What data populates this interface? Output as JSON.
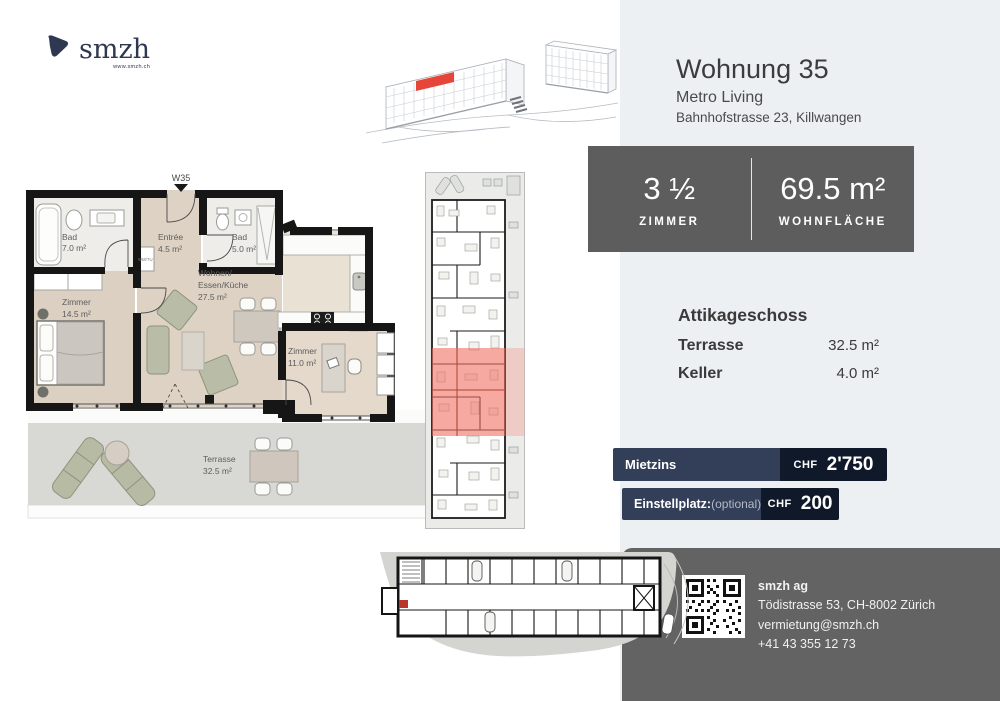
{
  "colors": {
    "navy": "#2e3850",
    "bar_left_navy": "#333f58",
    "bar_right_navy": "#10192a",
    "stats_gray": "#5d5d5d",
    "contact_gray": "#636363",
    "panel_gray": "#edf0f3",
    "highlight_red": "#e6463a",
    "plan_highlight_pink": "#ef6f63"
  },
  "logo": {
    "brand": "smzh",
    "url": "www.smzh.ch"
  },
  "header": {
    "title": "Wohnung 35",
    "project": "Metro Living",
    "address": "Bahnhofstrasse 23, Killwangen"
  },
  "stats": {
    "rooms": {
      "value": "3 ½",
      "label": "ZIMMER"
    },
    "area": {
      "value": "69.5 m²",
      "label": "WOHNFLÄCHE"
    }
  },
  "details": {
    "heading": "Attikageschoss",
    "rows": [
      {
        "label": "Terrasse",
        "value": "32.5 m²"
      },
      {
        "label": "Keller",
        "value": "4.0 m²"
      }
    ]
  },
  "pricing": {
    "rent": {
      "label": "Mietzins",
      "currency": "CHF",
      "amount": "2'750"
    },
    "parking": {
      "label": "Einstellplatz:",
      "note": "(optional)",
      "currency": "CHF",
      "amount": "200"
    }
  },
  "contact": {
    "company": "smzh ag",
    "address": "Tödistrasse 53, CH-8002 Zürich",
    "email": "vermietung@smzh.ch",
    "phone": "+41 43 355 12 73"
  },
  "floorplan": {
    "unit_marker": "W35",
    "appliance": "WM/TU",
    "rooms": {
      "bad1": {
        "name": "Bad",
        "area": "7.0 m²"
      },
      "zimmer1": {
        "name": "Zimmer",
        "area": "14.5 m²"
      },
      "entree": {
        "name": "Entrée",
        "area": "4.5 m²"
      },
      "bad2": {
        "name": "Bad",
        "area": "5.0 m²"
      },
      "wohnen": {
        "line1": "Wohnen/",
        "line2": "Essen/Küche",
        "area": "27.5 m²"
      },
      "zimmer2": {
        "name": "Zimmer",
        "area": "11.0 m²"
      },
      "terrasse": {
        "name": "Terrasse",
        "area": "32.5 m²"
      }
    }
  }
}
